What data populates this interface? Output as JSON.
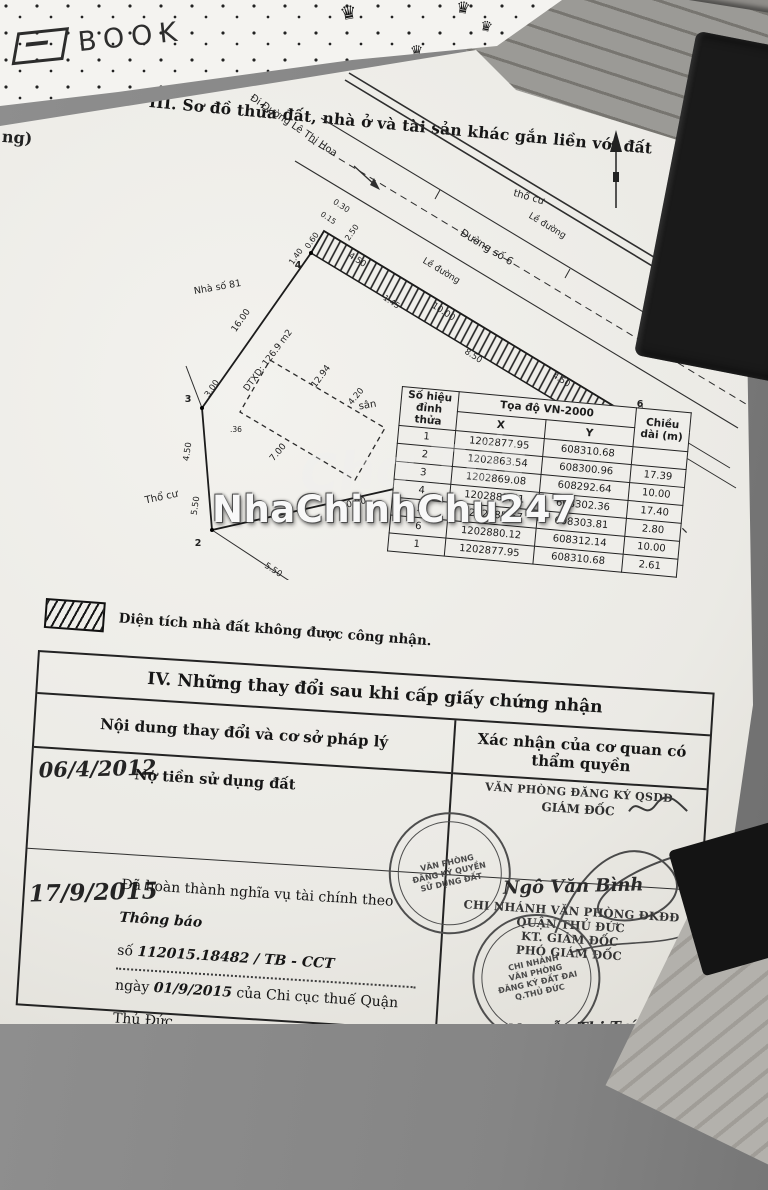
{
  "photo": {
    "brand_text": "BOOK",
    "crown_glyph": "♛",
    "watermark_main": "NhaChinhChu247",
    "watermark_faint": "Chợ Tốt"
  },
  "certificate": {
    "edge_text": "ng)",
    "section3_title": "III. Sơ đồ thửa đất, nhà ở và tài sản khác gắn liền với đất",
    "diagram": {
      "labels": [
        "Đi Đường Lê Thị Hoa",
        "thổ cư",
        "Lề đường",
        "Đường số 6",
        "Lề đường",
        "Nhà số 81",
        "DTXD: 126.9 m2",
        "12.94",
        "16.00",
        "4.20",
        "7.00",
        "sân",
        "Đất trống",
        "Ranh lộ giới",
        "Thổ cư",
        "0.30",
        "0.15",
        "2.50",
        "0.60",
        "1.40",
        "4.50",
        "10.00",
        "4.50",
        "1.45",
        "8.50",
        "0.30",
        "2.61",
        "5.30",
        "3.00",
        ".36",
        "4.50",
        "5.50",
        "10.00",
        "7.39",
        "5.50"
      ],
      "vertices": [
        "1",
        "2",
        "3",
        "4",
        "5",
        "6"
      ]
    },
    "coord_table": {
      "header_vertex": "Số hiệu đỉnh thửa",
      "header_coords": "Tọa độ VN-2000",
      "header_x": "X",
      "header_y": "Y",
      "header_length": "Chiều dài (m)",
      "rows": [
        {
          "v": "1",
          "x": "1202877.95",
          "y": "608310.68",
          "len": ""
        },
        {
          "v": "2",
          "x": "1202863.54",
          "y": "608300.96",
          "len": "17.39"
        },
        {
          "v": "3",
          "x": "1202869.08",
          "y": "608292.64",
          "len": "10.00"
        },
        {
          "v": "4",
          "x": "1202883.51",
          "y": "608302.36",
          "len": "17.40"
        },
        {
          "v": "5",
          "x": "1202885.67",
          "y": "608303.81",
          "len": "2.80"
        },
        {
          "v": "6",
          "x": "1202880.12",
          "y": "608312.14",
          "len": "10.00"
        },
        {
          "v": "1",
          "x": "1202877.95",
          "y": "608310.68",
          "len": "2.61"
        }
      ]
    },
    "legend_text": "Diện tích nhà đất không được công nhận.",
    "section4": {
      "title": "IV. Những thay đổi sau khi cấp giấy chứng nhận",
      "col_content": "Nội dung thay đổi và cơ sở pháp lý",
      "col_confirm": "Xác nhận của cơ quan có thẩm quyền",
      "row1": {
        "date": "06/4/2012",
        "content": "Nợ tiền sử dụng đất",
        "stamp_line1": "VĂN PHÒNG ĐĂNG KÝ QSDĐ",
        "stamp_line2": "GIÁM ĐỐC",
        "seal_lines": [
          "VĂN PHÒNG",
          "ĐĂNG KÝ QUYỀN",
          "SỬ DỤNG ĐẤT"
        ]
      },
      "row2": {
        "date": "17/9/2015",
        "printed1": "Đã hoàn thành nghĩa vụ tài chính theo",
        "hw1": "Thông báo",
        "printed2": "số",
        "hw2": "112015.18482 / TB - CCT",
        "printed3": "ngày",
        "hw3": "01/9/2015",
        "printed4": "của Chi cục thuế Quận Thủ Đức",
        "signature1": "Ngô Văn Bình",
        "stamp_lines": [
          "CHI NHÁNH VĂN PHÒNG ĐKĐĐ",
          "QUẬN THỦ ĐỨC",
          "KT. GIÁM ĐỐC",
          "PHÓ GIÁM ĐỐC"
        ],
        "seal_lines": [
          "CHI NHÁNH",
          "VĂN PHÒNG",
          "ĐĂNG KÝ ĐẤT ĐAI",
          "Q.THỦ ĐỨC"
        ],
        "signature2": "Nguyễn Thị Trúc Chăm"
      }
    }
  }
}
